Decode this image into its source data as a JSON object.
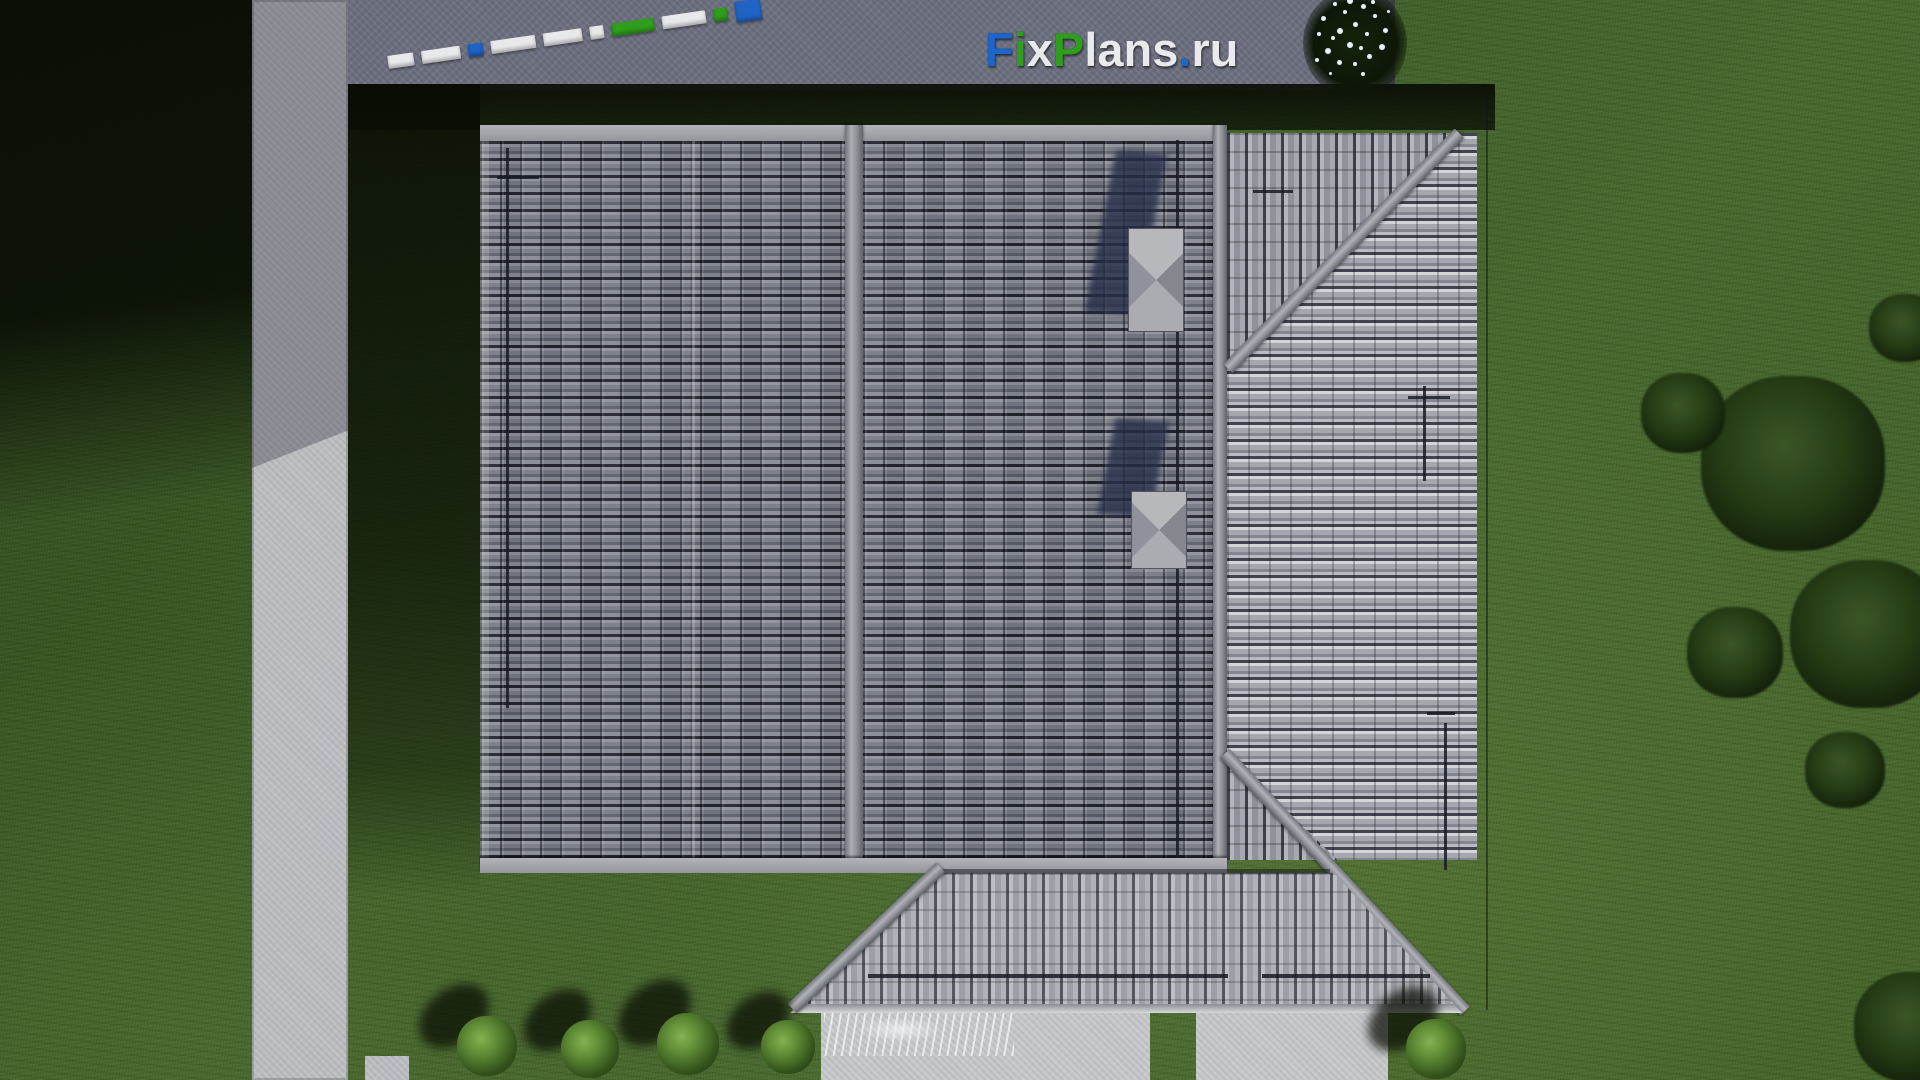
{
  "scene": {
    "description": "Aerial top-down 3D render of a house with gray tiled hip roof, lawn, concrete paths and pavement",
    "title": "FixPlans.ru house plan roof top view"
  },
  "watermark": {
    "text": "FixPlans.ru",
    "parts": [
      {
        "text": "F",
        "color": "blue"
      },
      {
        "text": "i",
        "color": "green"
      },
      {
        "text": "x",
        "color": "white"
      },
      {
        "text": "P",
        "color": "green"
      },
      {
        "text": "lans",
        "color": "white"
      },
      {
        "text": ".",
        "color": "blue"
      },
      {
        "text": "ru",
        "color": "white"
      }
    ],
    "colors": {
      "blue": "#1b65cb",
      "green": "#2f9e1c",
      "white": "#e9eaec"
    }
  },
  "colors": {
    "grass_mid": "#44622a",
    "grass_shadow": "#0b1205",
    "pavement": "#6d7080",
    "concrete_path": "#bcbec2",
    "roof_tile_dark": "#6f737d",
    "roof_tile_bright": "#c2c4c8",
    "roof_ridge": "#96989d",
    "chimney_shadow": "#242c48",
    "fence_white": "#e7e9ea",
    "fence_blue": "#1f63c4",
    "fence_green": "#2f9e1c",
    "foliage_dark": "#12200a",
    "shrub_green": "#5d8a34",
    "flower_white": "#e9edf0"
  },
  "fence": {
    "segments": [
      {
        "color": "white",
        "w": 26
      },
      {
        "color": "white",
        "w": 40
      },
      {
        "color": "blue",
        "w": 15
      },
      {
        "color": "white",
        "w": 46
      },
      {
        "color": "white",
        "w": 40
      },
      {
        "color": "white",
        "w": 14
      },
      {
        "color": "green",
        "w": 44
      },
      {
        "color": "white",
        "w": 44
      },
      {
        "color": "green",
        "w": 15
      },
      {
        "color": "blue",
        "w": 26,
        "tall": true
      }
    ]
  },
  "flower_bush": {
    "dots": [
      [
        18,
        28,
        5
      ],
      [
        30,
        14,
        4
      ],
      [
        44,
        10,
        6
      ],
      [
        58,
        16,
        5
      ],
      [
        70,
        26,
        4
      ],
      [
        80,
        40,
        5
      ],
      [
        76,
        56,
        6
      ],
      [
        64,
        66,
        5
      ],
      [
        50,
        74,
        4
      ],
      [
        34,
        72,
        5
      ],
      [
        22,
        60,
        6
      ],
      [
        14,
        44,
        4
      ],
      [
        34,
        40,
        6
      ],
      [
        50,
        34,
        5
      ],
      [
        62,
        44,
        4
      ],
      [
        44,
        54,
        6
      ],
      [
        28,
        48,
        4
      ],
      [
        56,
        58,
        4
      ],
      [
        40,
        22,
        4
      ],
      [
        68,
        12,
        4
      ],
      [
        84,
        22,
        3
      ],
      [
        12,
        70,
        4
      ],
      [
        58,
        84,
        4
      ],
      [
        26,
        84,
        3
      ]
    ]
  },
  "landscape": {
    "shrubs": [
      {
        "x": 487,
        "y": 1046,
        "r": 30
      },
      {
        "x": 590,
        "y": 1049,
        "r": 29
      },
      {
        "x": 688,
        "y": 1044,
        "r": 31
      },
      {
        "x": 788,
        "y": 1047,
        "r": 27
      },
      {
        "x": 1436,
        "y": 1049,
        "r": 30
      }
    ],
    "trees": [
      {
        "x": 1793,
        "y": 468,
        "r": 92
      },
      {
        "x": 1868,
        "y": 638,
        "r": 78
      },
      {
        "x": 1735,
        "y": 655,
        "r": 48
      },
      {
        "x": 1683,
        "y": 415,
        "r": 42
      },
      {
        "x": 1905,
        "y": 330,
        "r": 36
      },
      {
        "x": 1845,
        "y": 772,
        "r": 40
      },
      {
        "x": 1912,
        "y": 1030,
        "r": 58
      }
    ]
  }
}
